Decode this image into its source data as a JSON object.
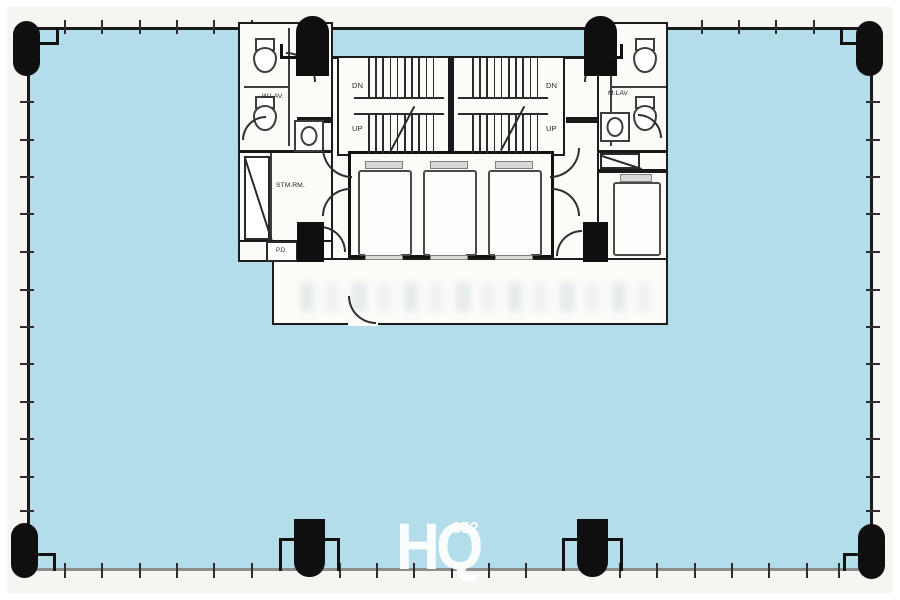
{
  "colors": {
    "floor_fill": "#b2dde9",
    "wall_line": "#1a1a1a",
    "column_fill": "#0f0f0f",
    "core_fill": "#fbfbf8",
    "bottom_edge_line": "#8d8d8d",
    "watermark_text": "#ffffff"
  },
  "plan": {
    "lavatory_left_label": "W.LAV.",
    "lavatory_right_label": "M.LAV.",
    "store_room_label": "STM.RM.",
    "pipe_duct_label": "P.D.",
    "stair_left": {
      "down_label": "DN",
      "up_label": "UP"
    },
    "stair_right": {
      "down_label": "DN",
      "up_label": "UP"
    }
  },
  "watermark": {
    "text": "HQ",
    "superscript": "852"
  }
}
